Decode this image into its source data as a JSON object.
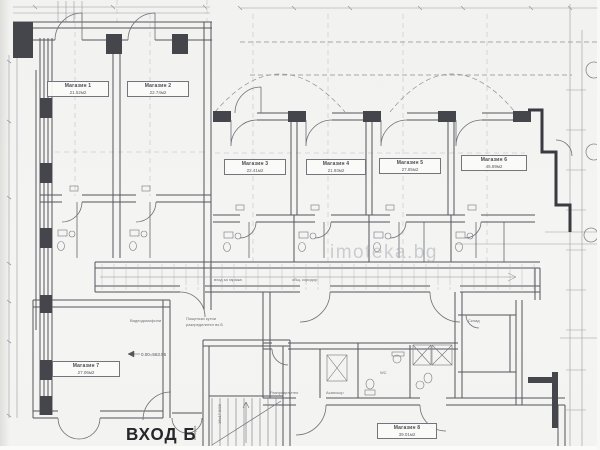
{
  "entrance": {
    "label": "ВХОД Б"
  },
  "watermark": {
    "text": "imoteka.bg"
  },
  "level_mark": {
    "text": "0.00=563.55"
  },
  "rooms": [
    {
      "name": "Магазин 1",
      "area": "21.52м2"
    },
    {
      "name": "Магазин 2",
      "area": "22.74м2"
    },
    {
      "name": "Магазин 3",
      "area": "22.41м2"
    },
    {
      "name": "Магазин 4",
      "area": "21.93м2"
    },
    {
      "name": "Магазин 5",
      "area": "27.85м2"
    },
    {
      "name": "Магазин 6",
      "area": "45.89м2"
    },
    {
      "name": "Магазин 7",
      "area": "27.06м2"
    },
    {
      "name": "Магазин 8",
      "area": "39.01м2"
    }
  ],
  "annotations": {
    "corridor_left": "вход за гаража",
    "corridor_right": "общ. коридор",
    "video": "Видеодомофони",
    "mail": "Пощенски кутии",
    "mail2": "разпределител вх.Б",
    "distribution": "Разпределител",
    "elevator": "Асансьор",
    "storage": "Склад",
    "wc": "WC",
    "stair_note": "16х17.5/28",
    "canopy": "козирка"
  },
  "colors": {
    "paper": "#f3f3f1",
    "line": "#6f6f77",
    "wall": "#45454c",
    "dim": "#9b9ba3",
    "text": "#4a4a50",
    "watermark": "#a8adb5",
    "dark": "#26262b"
  }
}
